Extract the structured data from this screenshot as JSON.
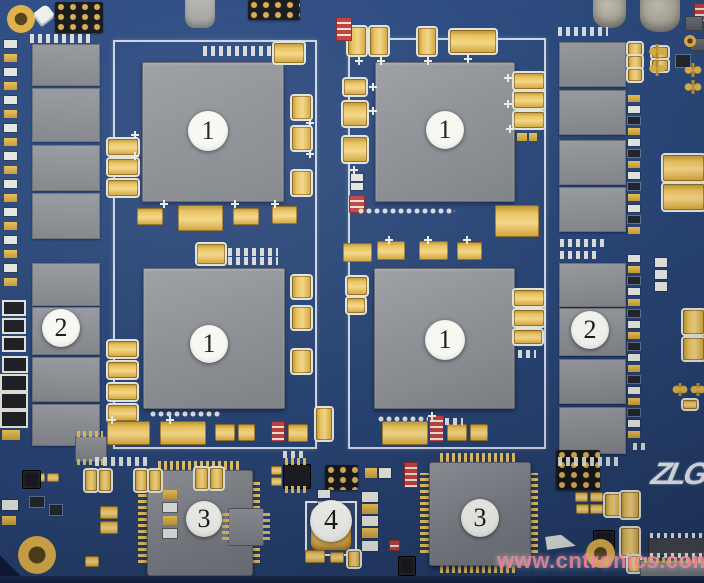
{
  "callouts": {
    "items": [
      {
        "label": "1"
      },
      {
        "label": "1"
      },
      {
        "label": "1"
      },
      {
        "label": "1"
      },
      {
        "label": "2"
      },
      {
        "label": "2"
      },
      {
        "label": "3"
      },
      {
        "label": "3"
      },
      {
        "label": "4"
      }
    ]
  },
  "watermark": {
    "text": "www.cntronics.com"
  },
  "logo": {
    "text": "ZLG"
  },
  "colors": {
    "pcb_blue": "#2b4879",
    "chip_gray": "#8d9095",
    "capacitor_gold": "#e9c25e",
    "silkscreen_white": "#e6e8e2",
    "black_component": "#16181c",
    "red_component": "#bf4040",
    "callout_fill": "#f8f8f3",
    "callout_text": "#1c1c1c",
    "watermark_pink": "#f2879d",
    "logo_white": "#eaeef5"
  }
}
